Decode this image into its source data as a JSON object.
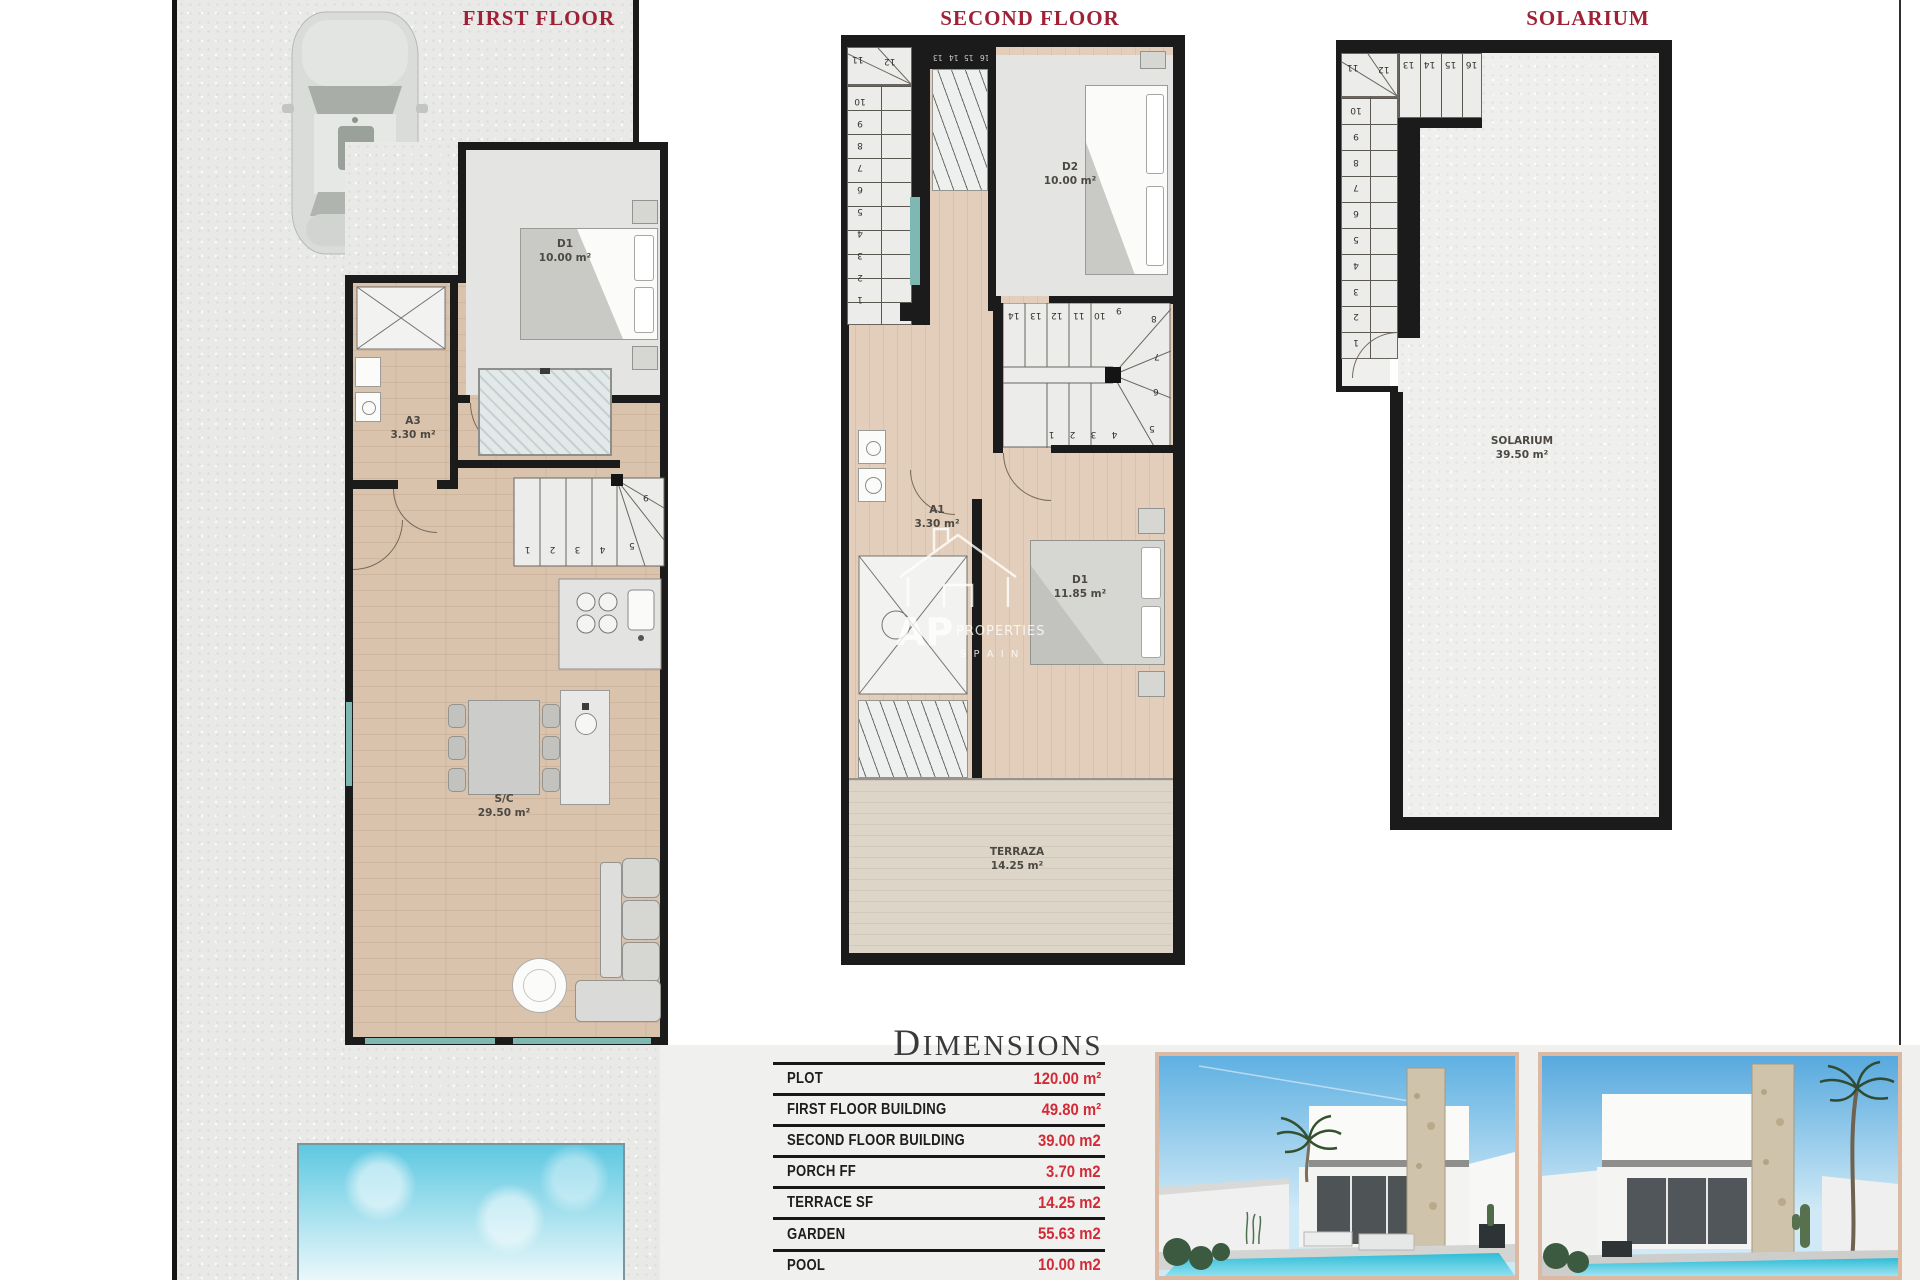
{
  "titles": {
    "first_floor": "FIRST FLOOR",
    "second_floor": "SECOND FLOOR",
    "solarium": "SOLARIUM"
  },
  "rooms": {
    "ff_d1": {
      "name": "D1",
      "area": "10.00 m²"
    },
    "ff_a3": {
      "name": "A3",
      "area": "3.30 m²"
    },
    "ff_sc": {
      "name": "S/C",
      "area": "29.50 m²"
    },
    "sf_d2": {
      "name": "D2",
      "area": "10.00 m²"
    },
    "sf_a1": {
      "name": "A1",
      "area": "3.30 m²"
    },
    "sf_d1": {
      "name": "D1",
      "area": "11.85 m²"
    },
    "sf_terraza": {
      "name": "TERRAZA",
      "area": "14.25 m²"
    },
    "solarium": {
      "name": "SOLARIUM",
      "area": "39.50 m²"
    }
  },
  "stairs": {
    "ff": {
      "run": [
        "1",
        "2",
        "3",
        "4"
      ],
      "fan": [
        "5",
        "9"
      ]
    },
    "sf_left": {
      "run": [
        "1",
        "2",
        "3",
        "4",
        "5",
        "6",
        "7",
        "8",
        "9",
        "10"
      ],
      "winders": [
        "11",
        "12"
      ],
      "upper": [
        "13",
        "14",
        "15",
        "16"
      ]
    },
    "sf_mid": {
      "top": [
        "14",
        "13",
        "12",
        "11",
        "10"
      ],
      "bottom": [
        "1",
        "2",
        "3",
        "4"
      ],
      "fan": [
        "9",
        "8",
        "7",
        "6",
        "5"
      ]
    },
    "sol": {
      "run": [
        "1",
        "2",
        "3",
        "4",
        "5",
        "6",
        "7",
        "8",
        "9",
        "10"
      ],
      "winders": [
        "11",
        "12"
      ],
      "upper": [
        "13",
        "14",
        "15",
        "16"
      ]
    }
  },
  "watermark": {
    "ap": "AP",
    "properties": "PROPERTIES",
    "spain": "S P A I N"
  },
  "dimensions": {
    "title": "DIMENSIONS",
    "rows": [
      {
        "label": "PLOT",
        "value": "120.00 m²"
      },
      {
        "label": "FIRST FLOOR BUILDING",
        "value": "49.80 m²"
      },
      {
        "label": "SECOND FLOOR BUILDING",
        "value": "39.00 m2"
      },
      {
        "label": "PORCH FF",
        "value": "3.70 m2"
      },
      {
        "label": "TERRACE SF",
        "value": "14.25 m2"
      },
      {
        "label": "GARDEN",
        "value": "55.63 m2"
      },
      {
        "label": "POOL",
        "value": "10.00 m2"
      }
    ]
  },
  "colors": {
    "title_red": "#9e2136",
    "value_red": "#d22b38",
    "wall_black": "#1b1b1b",
    "window_teal": "#7fb8b3",
    "wood_floor": "#d9c3ad",
    "gray_floor": "#e4e4e2",
    "plot_gray": "#e9e9e7",
    "pool_blue": "#62c9e2",
    "photo_frame": "#dcb9a2"
  }
}
